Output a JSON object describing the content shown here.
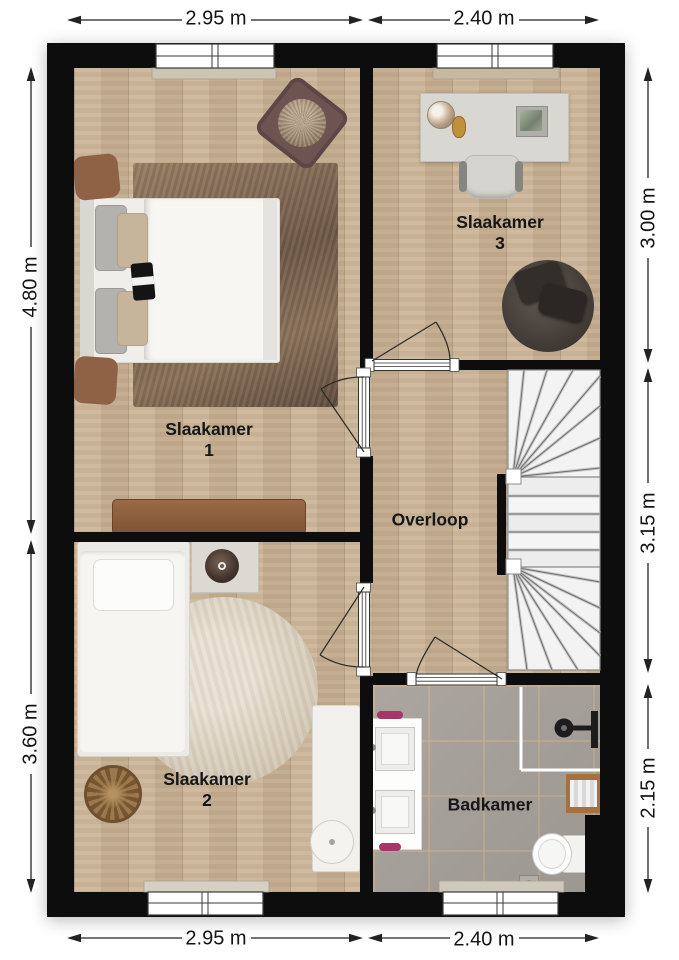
{
  "rooms": [
    {
      "name": "Slaakamer",
      "number": "1"
    },
    {
      "name": "Slaakamer",
      "number": "2"
    },
    {
      "name": "Slaakamer",
      "number": "3"
    },
    {
      "name": "Overloop",
      "number": ""
    },
    {
      "name": "Badkamer",
      "number": ""
    }
  ],
  "dims": {
    "top": [
      "2.95 m",
      "2.40 m"
    ],
    "bottom": [
      "2.95 m",
      "2.40 m"
    ],
    "left": [
      "4.80 m",
      "3.60 m"
    ],
    "right": [
      "3.00 m",
      "3.15 m",
      "2.15 m"
    ]
  },
  "colors": {
    "wall": "#0d0d0d",
    "wood_floor": "#c9b294",
    "tile_floor": "#a6a09a",
    "rug_dark": "#7c654f",
    "rug_light": "#d6cbb9",
    "stairs": "#f2f2f2",
    "accent_magenta": "#a93568",
    "dimension_text": "#141414",
    "label_text": "#161616"
  }
}
